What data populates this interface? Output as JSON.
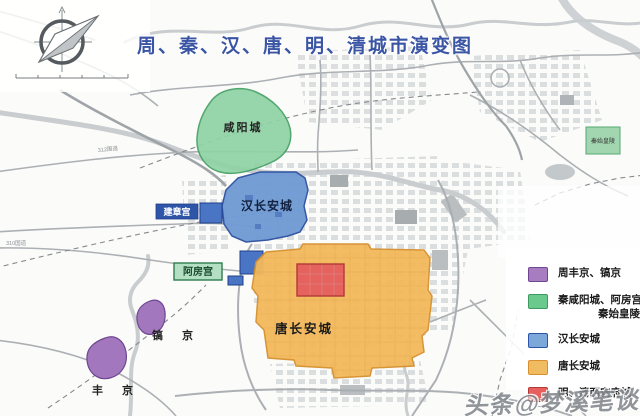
{
  "title": {
    "text": "周、秦、汉、唐、明、清城市演变图",
    "color": "#3a55a4"
  },
  "map_labels": {
    "xianyang_city": "咸阳城",
    "qin_mausoleum": "秦始皇陵",
    "han_changan": "汉长安城",
    "jianzhang_palace": "建章宫",
    "epang_palace": "阿房宫",
    "tang_changan": "唐长安城",
    "haojing": "镐 京",
    "fengjing": "丰 京",
    "road_312": "312国道",
    "road_310": "310国道"
  },
  "legend": {
    "items": [
      {
        "label": "周丰京、镐京",
        "label2": "",
        "color": "#a87cc0",
        "border": "#6f4690"
      },
      {
        "label": "秦咸阳城、阿房宫",
        "label2": "秦始皇陵",
        "color": "#6cc98e",
        "border": "#3e9a62"
      },
      {
        "label": "汉长安城",
        "label2": "",
        "color": "#7ba7d9",
        "border": "#2d54a8"
      },
      {
        "label": "唐长安城",
        "label2": "",
        "color": "#f0bc62",
        "border": "#d98f2b"
      },
      {
        "label": "明、清西安府城",
        "label2": "",
        "color": "#e8605e",
        "border": "#b23a36"
      }
    ]
  },
  "watermark": "头条@梦溪笔谈",
  "colors": {
    "title_blue": "#3a55a4",
    "zhou_purple": "#a277bd",
    "qin_green": "#8fd2a4",
    "han_blue": "#6e9ad4",
    "tang_orange": "#f3b95c",
    "ming_qing_red": "#e5625e",
    "road_gray": "#a8adb1",
    "river_gray": "#c9cdcf"
  }
}
